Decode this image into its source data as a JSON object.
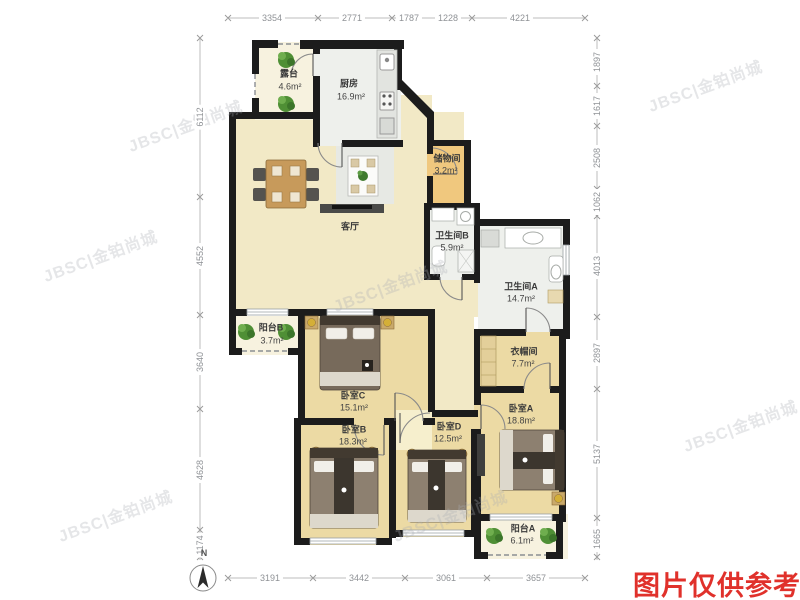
{
  "watermark": {
    "text": "JBSC|金铂尚城"
  },
  "note": {
    "text": "图片仅供参考",
    "color": "#e0312b"
  },
  "compass": {
    "label": "N"
  },
  "rooms": {
    "terrace": {
      "name": "露台",
      "area": "4.6m²"
    },
    "kitchen": {
      "name": "厨房",
      "area": "16.9m²"
    },
    "living": {
      "name": "客厅"
    },
    "storage": {
      "name": "储物间",
      "area": "3.2m²"
    },
    "bath_b": {
      "name": "卫生间B",
      "area": "5.9m²"
    },
    "bath_a": {
      "name": "卫生间A",
      "area": "14.7m²"
    },
    "balcony_b": {
      "name": "阳台B",
      "area": "3.7m²"
    },
    "bed_c": {
      "name": "卧室C",
      "area": "15.1m²"
    },
    "closet": {
      "name": "衣帽间",
      "area": "7.7m²"
    },
    "bed_b": {
      "name": "卧室B",
      "area": "18.3m²"
    },
    "bed_d": {
      "name": "卧室D",
      "area": "12.5m²"
    },
    "bed_a": {
      "name": "卧室A",
      "area": "18.8m²"
    },
    "balcony_a": {
      "name": "阳台A",
      "area": "6.1m²"
    }
  },
  "dimensions": {
    "top": [
      "3354",
      "2771",
      "1787",
      "1228",
      "4221"
    ],
    "bottom": [
      "3191",
      "3442",
      "3061",
      "3657"
    ],
    "left": [
      "6112",
      "4552",
      "3640",
      "4628",
      "1174"
    ],
    "right": [
      "1897",
      "1617",
      "2508",
      "1062",
      "4013",
      "2897",
      "5137",
      "1665"
    ]
  },
  "colors": {
    "wall": "#1c1c1c",
    "living_floor": "#f2e9c6",
    "bedroom_floor": "#ecdaa4",
    "wet_floor": "#eef0ec",
    "storage_floor": "#f0c87e",
    "balcony_floor": "#f7f2df",
    "note_red": "#e0312b"
  }
}
